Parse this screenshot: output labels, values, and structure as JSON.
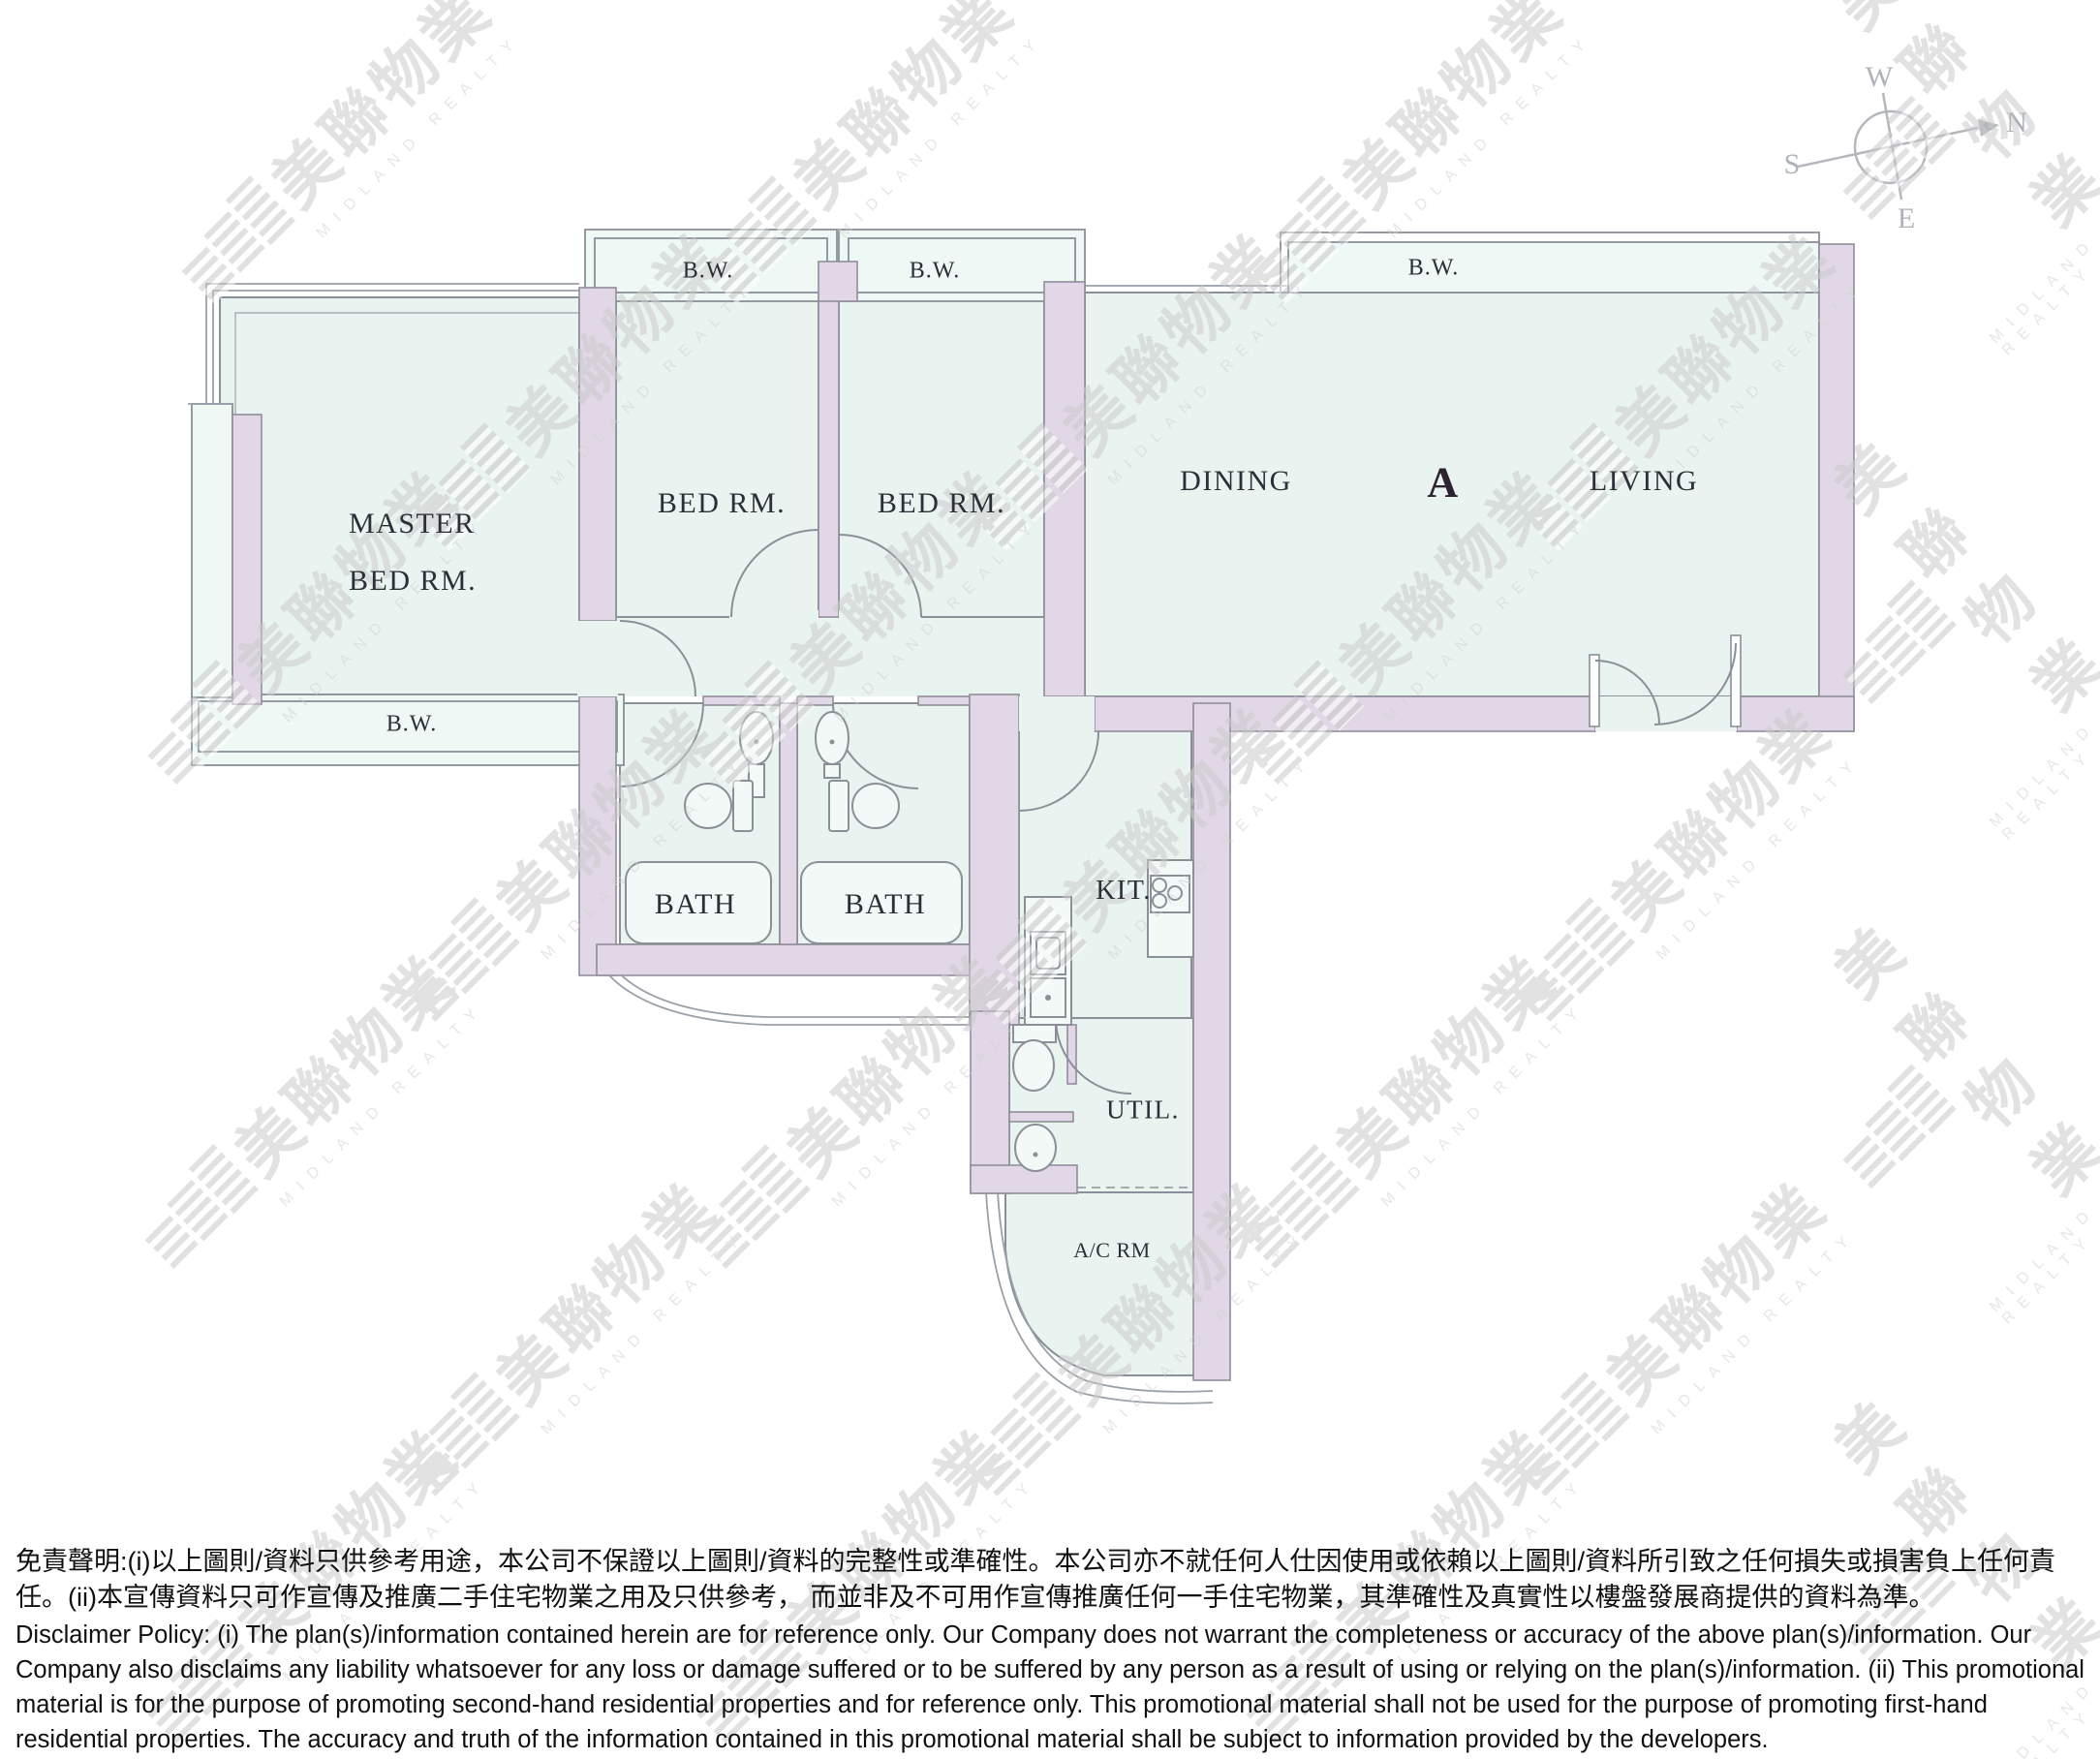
{
  "plan": {
    "unit_label": "A",
    "rooms": {
      "master_line1": "MASTER",
      "master_line2": "BED RM.",
      "bed1": "BED RM.",
      "bed2": "BED RM.",
      "dining": "DINING",
      "living": "LIVING",
      "bath1": "BATH",
      "bath2": "BATH",
      "kitchen": "KIT.",
      "utility": "UTIL.",
      "ac_room": "A/C RM"
    },
    "bay_windows": {
      "master": "B.W.",
      "bed1": "B.W.",
      "bed2": "B.W.",
      "living": "B.W."
    },
    "colors": {
      "room_fill": "#e9f4f0",
      "bay_fill": "#eef8f4",
      "wall_fill": "#e2d7e6",
      "line": "#8a8f98",
      "label": "#2c2f37"
    }
  },
  "compass": {
    "n": "N",
    "s": "S",
    "e": "E",
    "w": "W"
  },
  "watermark": {
    "logo_text": "美聯物業",
    "brand_text": "MIDLAND REALTY"
  },
  "disclaimer": {
    "zh": "免責聲明:(i)以上圖則/資料只供參考用途，本公司不保證以上圖則/資料的完整性或準確性。本公司亦不就任何人仕因使用或依賴以上圖則/資料所引致之任何損失或損害負上任何責任。(ii)本宣傳資料只可作宣傳及推廣二手住宅物業之用及只供參考， 而並非及不可用作宣傳推廣任何一手住宅物業，其準確性及真實性以樓盤發展商提供的資料為準。",
    "en": "Disclaimer Policy: (i) The plan(s)/information contained herein are for reference only. Our Company does not warrant the completeness or accuracy of the above plan(s)/information. Our Company also disclaims any liability whatsoever for any loss or damage suffered or to be suffered by any person as a result of using or relying on the plan(s)/information. (ii) This promotional material is for the purpose of promoting second-hand residential properties and for reference only. This promotional material shall not be used for the purpose of promoting first-hand residential properties. The accuracy and truth of the information contained in this promotional material shall be subject to information provided by the developers."
  }
}
